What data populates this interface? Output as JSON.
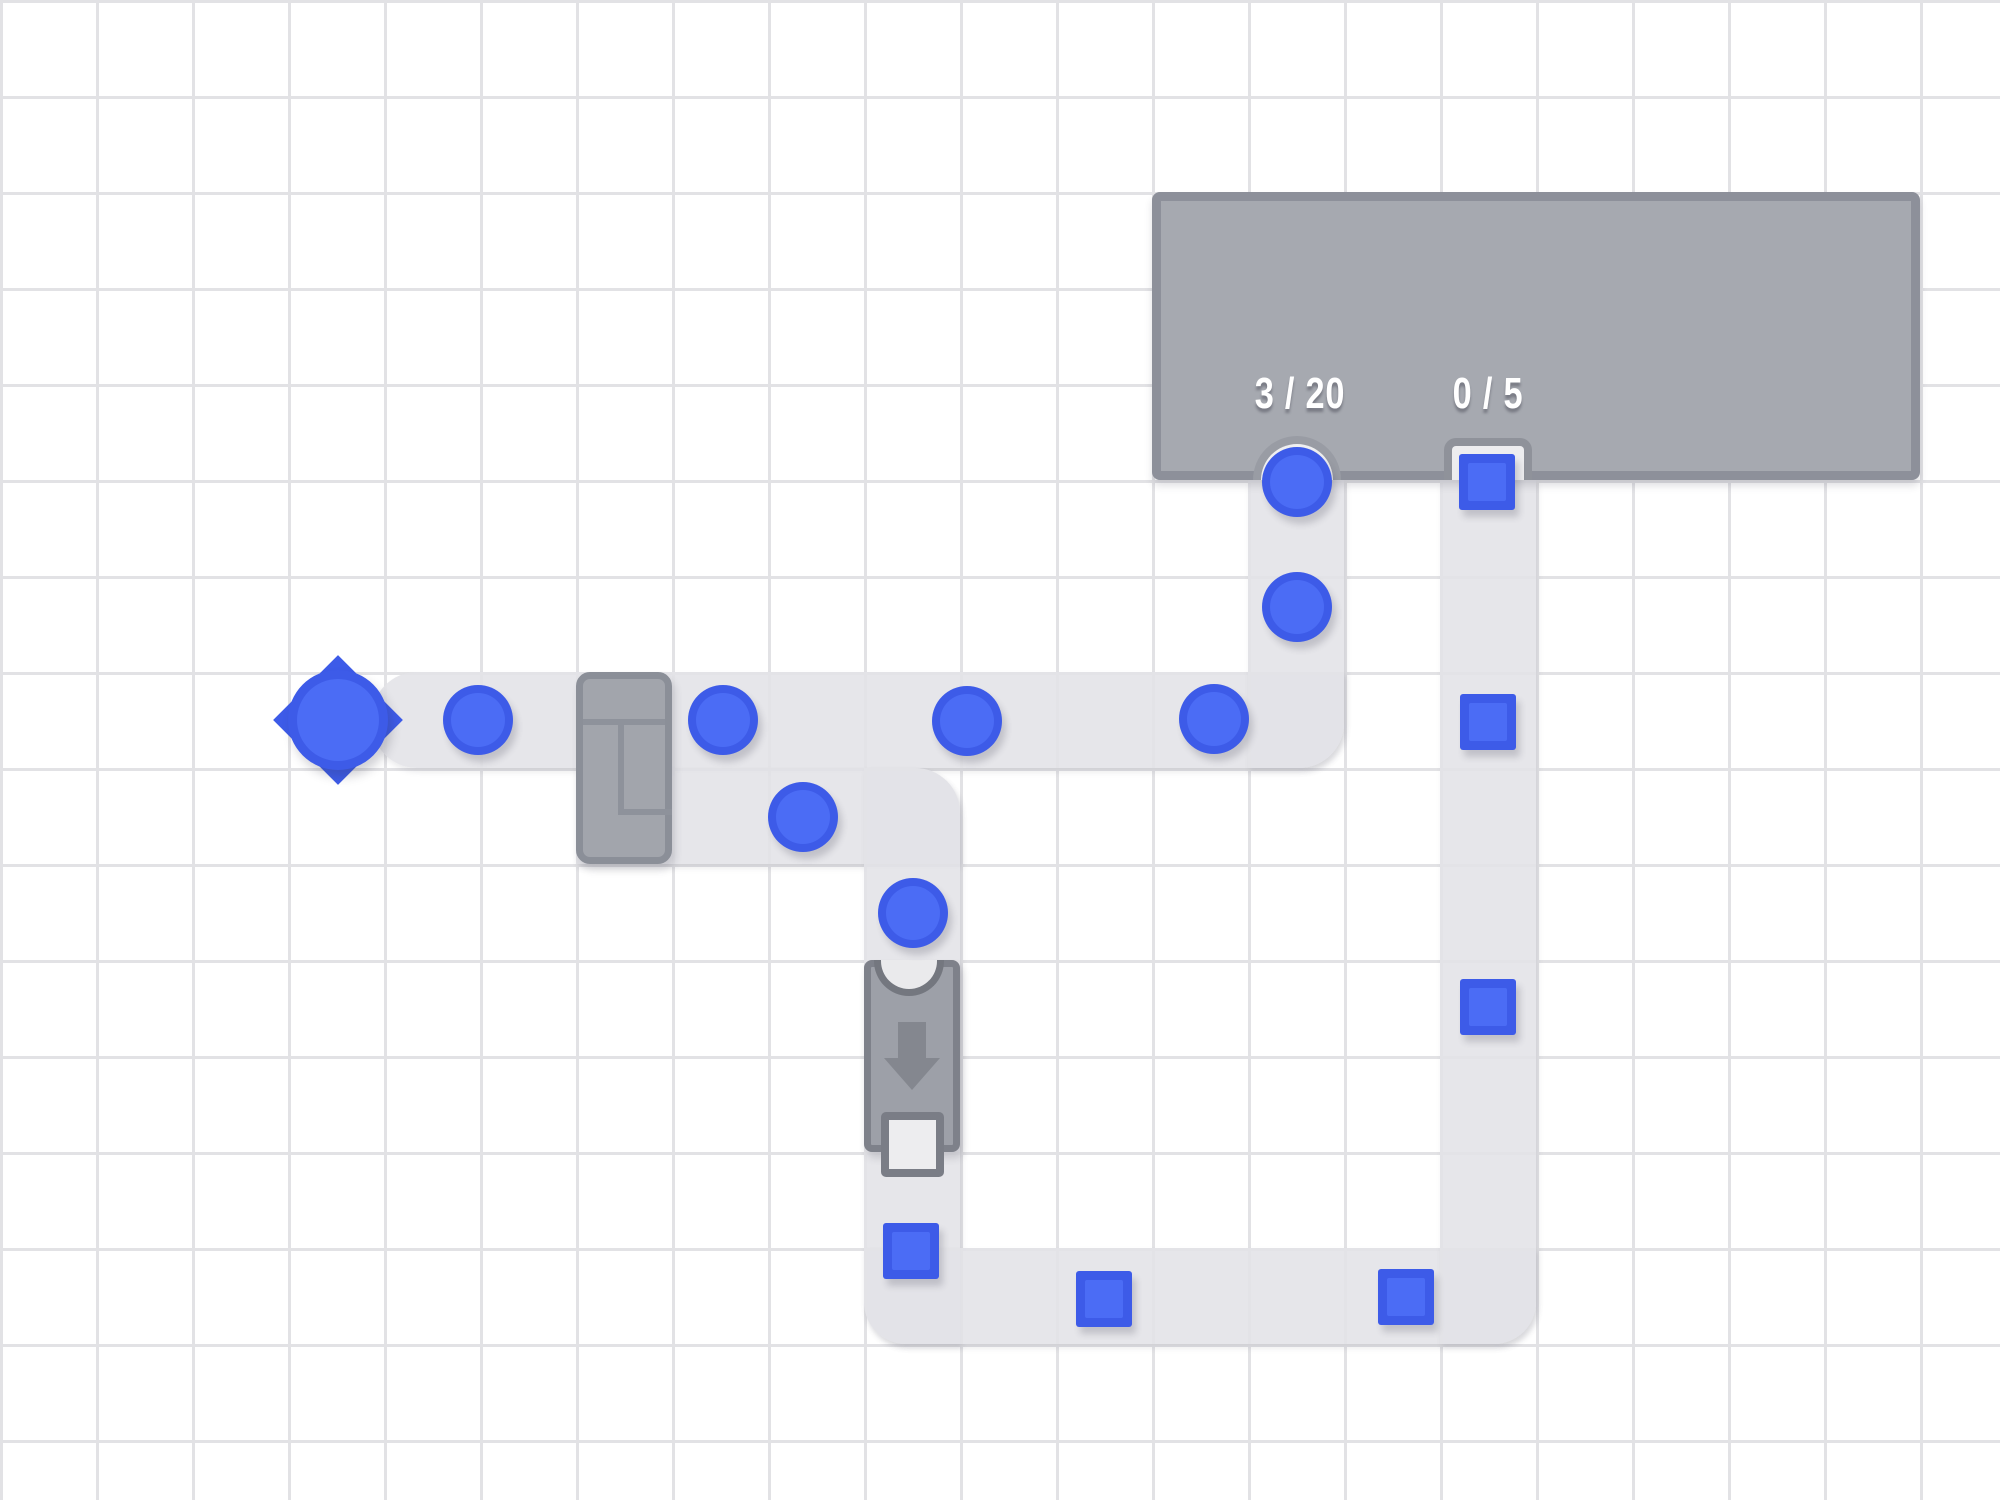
{
  "scene": {
    "width": 2000,
    "height": 1500
  },
  "grid": {
    "cell": 96,
    "line_width": 3,
    "line_color": "#e2e2e5",
    "bg_color": "#ffffff"
  },
  "colors": {
    "item_ring": "#3D5BE8",
    "item_fill": "#4B6CF5",
    "belt": "#e7e7ea",
    "building_fill": "#a6a9b0",
    "building_border": "#8d909a",
    "machine_fill": "#a2a5ac",
    "machine_border": "#82858e",
    "notch_fill": "#efeff1",
    "counter_text": "#ffffff"
  },
  "building": {
    "x": 1152,
    "y": 192,
    "w": 768,
    "h": 288,
    "counter_cy": 394,
    "counters": [
      {
        "id": "circles",
        "label": "3 / 20",
        "cx": 1300
      },
      {
        "id": "squares",
        "label": "0 / 5",
        "cx": 1488
      }
    ],
    "intakes": [
      {
        "shape": "circle",
        "cx": 1297
      },
      {
        "shape": "square",
        "cx": 1488
      }
    ]
  },
  "belts": [
    {
      "x": 372,
      "y": 672,
      "w": 972,
      "h": 96,
      "r": "45px 0 45px 45px"
    },
    {
      "x": 1248,
      "y": 480,
      "w": 96,
      "h": 288,
      "r": "0 0 45px 0"
    },
    {
      "x": 576,
      "y": 768,
      "w": 384,
      "h": 96,
      "r": "0 45px 0 0"
    },
    {
      "x": 864,
      "y": 768,
      "w": 96,
      "h": 576,
      "r": "0 45px 0 42px"
    },
    {
      "x": 864,
      "y": 1248,
      "w": 672,
      "h": 96,
      "r": "0 0 42px 42px"
    },
    {
      "x": 1440,
      "y": 480,
      "w": 96,
      "h": 864,
      "r": "0 0 42px 0"
    }
  ],
  "spawner": {
    "cx": 338,
    "cy": 720,
    "spike_offset": 38
  },
  "machines": {
    "splitter": {
      "x": 576,
      "y": 672,
      "w": 96,
      "h": 192
    },
    "converter": {
      "x": 864,
      "y": 960,
      "w": 96,
      "h": 192
    }
  },
  "items": [
    {
      "shape": "circle",
      "x": 478,
      "y": 720,
      "size": 70
    },
    {
      "shape": "circle",
      "x": 723,
      "y": 720,
      "size": 70
    },
    {
      "shape": "circle",
      "x": 967,
      "y": 721,
      "size": 70
    },
    {
      "shape": "circle",
      "x": 1214,
      "y": 719,
      "size": 70
    },
    {
      "shape": "circle",
      "x": 803,
      "y": 817,
      "size": 70
    },
    {
      "shape": "circle",
      "x": 913,
      "y": 913,
      "size": 70
    },
    {
      "shape": "circle",
      "x": 1297,
      "y": 607,
      "size": 70
    },
    {
      "shape": "circle",
      "x": 1297,
      "y": 482,
      "size": 70
    },
    {
      "shape": "square",
      "x": 1487,
      "y": 482,
      "size": 56
    },
    {
      "shape": "square",
      "x": 1488,
      "y": 722,
      "size": 56
    },
    {
      "shape": "square",
      "x": 1488,
      "y": 1007,
      "size": 56
    },
    {
      "shape": "square",
      "x": 911,
      "y": 1251,
      "size": 56
    },
    {
      "shape": "square",
      "x": 1104,
      "y": 1299,
      "size": 56
    },
    {
      "shape": "square",
      "x": 1406,
      "y": 1297,
      "size": 56
    }
  ]
}
